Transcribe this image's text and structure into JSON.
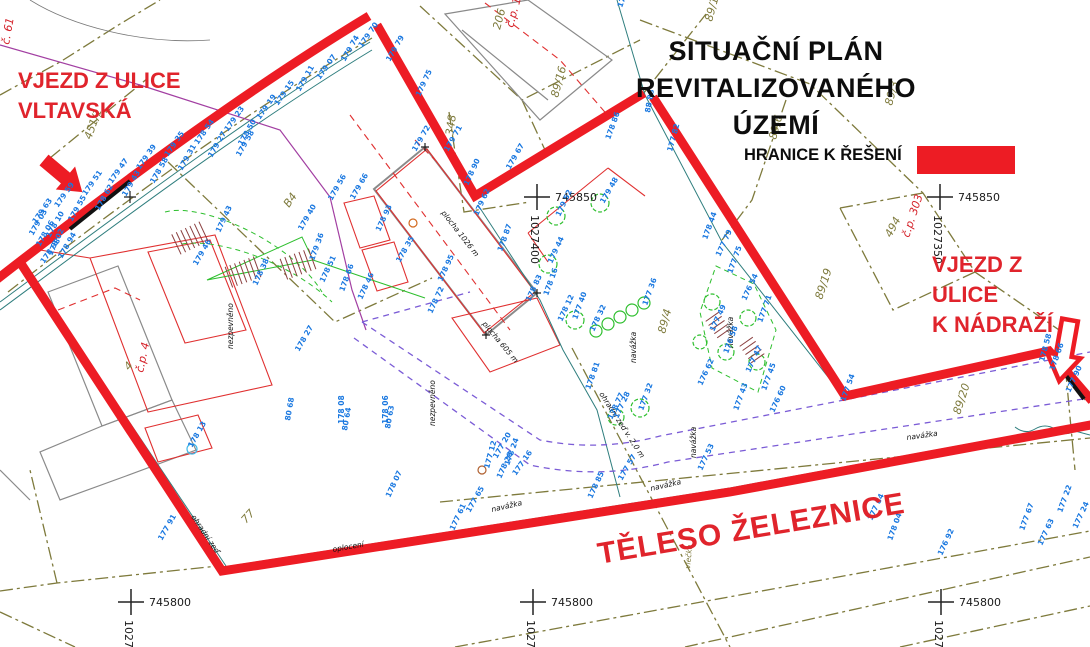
{
  "title": {
    "line1": "SITUAČNÍ PLÁN REVITALIZOVANÉHO",
    "line2": "ÚZEMÍ"
  },
  "legend": {
    "label": "HRANICE K ŘEŠENÍ",
    "swatch_color": "#ED1C24"
  },
  "annotations": {
    "entrance_vltavska": {
      "line1": "VJEZD Z ULICE",
      "line2": "VLTAVSKÁ"
    },
    "entrance_nadrazi": {
      "line1": "VJEZD Z ULICE",
      "line2": "K NÁDRAŽÍ"
    },
    "railway_body": "TĚLESO ŽELEZNICE"
  },
  "colors": {
    "boundary_red": "#ED1C24",
    "annotation_red": "#e0242c",
    "point_blue": "#1a78e0",
    "parcel_olive": "#7e7a3c",
    "teal": "#2f7e7e",
    "violet_dashed": "#7b5cd6",
    "purple": "#a23fa2",
    "green": "#2ebf2e",
    "hatch_brown": "#8b4040"
  },
  "grid_crosses": [
    {
      "x": 537,
      "y": 197,
      "easting": "745850",
      "northing": "1027400"
    },
    {
      "x": 940,
      "y": 197,
      "easting": "745850",
      "northing": "1027350"
    },
    {
      "x": 131,
      "y": 602,
      "easting": "745800",
      "northing": "1027450"
    },
    {
      "x": 533,
      "y": 602,
      "easting": "745800",
      "northing": "1027400"
    },
    {
      "x": 941,
      "y": 602,
      "easting": "745800",
      "northing": "1027350"
    }
  ],
  "parcel_labels": [
    {
      "t": "89/16",
      "x": 558,
      "y": 98,
      "r": -75,
      "c": "olive"
    },
    {
      "t": "89/11",
      "x": 712,
      "y": 22,
      "r": -75,
      "c": "olive"
    },
    {
      "t": "89/3",
      "x": 892,
      "y": 106,
      "r": -75,
      "c": "olive"
    },
    {
      "t": "89/6",
      "x": 776,
      "y": 140,
      "r": -75,
      "c": "olive"
    },
    {
      "t": "89/19",
      "x": 822,
      "y": 300,
      "r": -72,
      "c": "olive"
    },
    {
      "t": "89/20",
      "x": 960,
      "y": 415,
      "r": -72,
      "c": "olive"
    },
    {
      "t": "89/4",
      "x": 665,
      "y": 334,
      "r": -75,
      "c": "olive"
    },
    {
      "t": "348",
      "x": 453,
      "y": 136,
      "r": -82,
      "c": "olive"
    },
    {
      "t": "B4",
      "x": 289,
      "y": 208,
      "r": -55,
      "c": "olive"
    },
    {
      "t": "206",
      "x": 500,
      "y": 30,
      "r": -75,
      "c": "olive"
    },
    {
      "t": "451/1",
      "x": 91,
      "y": 140,
      "r": -70,
      "c": "olive"
    },
    {
      "t": "4",
      "x": 129,
      "y": 371,
      "r": -50,
      "c": "olive"
    },
    {
      "t": "77",
      "x": 246,
      "y": 524,
      "r": -48,
      "c": "olive"
    },
    {
      "t": "494",
      "x": 891,
      "y": 238,
      "r": -62,
      "c": "olive"
    },
    {
      "t": "č.p. 177",
      "x": 513,
      "y": 28,
      "r": -75,
      "c": "red"
    },
    {
      "t": "č.p. 303",
      "x": 909,
      "y": 238,
      "r": -72,
      "c": "red"
    },
    {
      "t": "č.p. 4",
      "x": 143,
      "y": 373,
      "r": -78,
      "c": "red"
    },
    {
      "t": "č. 61",
      "x": 9,
      "y": 45,
      "r": -80,
      "c": "red"
    }
  ],
  "surface_labels": [
    {
      "t": "nezpevněno",
      "x": 233,
      "y": 349,
      "r": -90
    },
    {
      "t": "nezpevněno",
      "x": 435,
      "y": 426,
      "r": -90
    },
    {
      "t": "navážka",
      "x": 636,
      "y": 363,
      "r": -90
    },
    {
      "t": "navážka",
      "x": 733,
      "y": 348,
      "r": -90
    },
    {
      "t": "navážka",
      "x": 696,
      "y": 458,
      "r": -90
    },
    {
      "t": "navážka",
      "x": 492,
      "y": 512,
      "r": -13
    },
    {
      "t": "navážka",
      "x": 651,
      "y": 491,
      "r": -13
    },
    {
      "t": "navážka",
      "x": 907,
      "y": 440,
      "r": -8
    },
    {
      "t": "ohradní zeď",
      "x": 191,
      "y": 517,
      "r": 56
    },
    {
      "t": "ohradní zeď v. 2,0 m",
      "x": 599,
      "y": 394,
      "r": 57
    },
    {
      "t": "oplocení",
      "x": 333,
      "y": 552,
      "r": -10
    },
    {
      "t": "plocha 1026 m",
      "x": 441,
      "y": 213,
      "r": 52
    },
    {
      "t": "plocha 605 m",
      "x": 482,
      "y": 324,
      "r": 50
    },
    {
      "t": "vlečka",
      "x": 690,
      "y": 569,
      "r": -85,
      "c": "olive"
    }
  ],
  "point_labels": [
    {
      "t": "179 63",
      "x": 36,
      "y": 224,
      "r": -55
    },
    {
      "t": "178 10",
      "x": 50,
      "y": 238,
      "r": -60
    },
    {
      "t": "179 59",
      "x": 58,
      "y": 208,
      "r": -55
    },
    {
      "t": "179 55",
      "x": 72,
      "y": 222,
      "r": -60
    },
    {
      "t": "179 51",
      "x": 86,
      "y": 196,
      "r": -55
    },
    {
      "t": "178 62",
      "x": 99,
      "y": 211,
      "r": -60
    },
    {
      "t": "179 47",
      "x": 112,
      "y": 184,
      "r": -55
    },
    {
      "t": "179 43",
      "x": 126,
      "y": 197,
      "r": -60
    },
    {
      "t": "179 39",
      "x": 140,
      "y": 170,
      "r": -55
    },
    {
      "t": "178 58",
      "x": 154,
      "y": 184,
      "r": -60
    },
    {
      "t": "179 35",
      "x": 168,
      "y": 157,
      "r": -55
    },
    {
      "t": "179 31",
      "x": 182,
      "y": 171,
      "r": -60
    },
    {
      "t": "178 54",
      "x": 198,
      "y": 145,
      "r": -55
    },
    {
      "t": "179 27",
      "x": 212,
      "y": 158,
      "r": -60
    },
    {
      "t": "179 23",
      "x": 228,
      "y": 132,
      "r": -55
    },
    {
      "t": "178 50",
      "x": 242,
      "y": 146,
      "r": -60
    },
    {
      "t": "179 19",
      "x": 260,
      "y": 120,
      "r": -55
    },
    {
      "t": "179 15",
      "x": 278,
      "y": 106,
      "r": -55
    },
    {
      "t": "179 11",
      "x": 300,
      "y": 92,
      "r": -60
    },
    {
      "t": "179 07",
      "x": 320,
      "y": 80,
      "r": -55
    },
    {
      "t": "179 74",
      "x": 345,
      "y": 62,
      "r": -60
    },
    {
      "t": "179 70",
      "x": 362,
      "y": 48,
      "r": -55
    },
    {
      "t": "178 06",
      "x": 40,
      "y": 247,
      "r": -60
    },
    {
      "t": "178 02",
      "x": 52,
      "y": 256,
      "r": -65
    },
    {
      "t": "178 98",
      "x": 44,
      "y": 264,
      "r": -55
    },
    {
      "t": "178 94",
      "x": 62,
      "y": 259,
      "r": -60
    },
    {
      "t": "179 03",
      "x": 33,
      "y": 236,
      "r": -60
    },
    {
      "t": "179 79",
      "x": 390,
      "y": 62,
      "r": -60
    },
    {
      "t": "179 75",
      "x": 420,
      "y": 97,
      "r": -65
    },
    {
      "t": "179 71",
      "x": 448,
      "y": 152,
      "r": -60
    },
    {
      "t": "178 90",
      "x": 468,
      "y": 186,
      "r": -65
    },
    {
      "t": "88 88",
      "x": 650,
      "y": 113,
      "r": -80
    },
    {
      "t": "178 86",
      "x": 610,
      "y": 140,
      "r": -70
    },
    {
      "t": "177 82",
      "x": 672,
      "y": 152,
      "r": -75
    },
    {
      "t": "179 67",
      "x": 510,
      "y": 170,
      "r": -60
    },
    {
      "t": "179 62",
      "x": 478,
      "y": 216,
      "r": -65
    },
    {
      "t": "178 87",
      "x": 502,
      "y": 252,
      "r": -70
    },
    {
      "t": "178 83",
      "x": 530,
      "y": 302,
      "r": -65
    },
    {
      "t": "179 66",
      "x": 354,
      "y": 200,
      "r": -60
    },
    {
      "t": "178 93",
      "x": 380,
      "y": 232,
      "r": -65
    },
    {
      "t": "179 72",
      "x": 416,
      "y": 152,
      "r": -60
    },
    {
      "t": "178 95",
      "x": 442,
      "y": 282,
      "r": -65
    },
    {
      "t": "178 16",
      "x": 548,
      "y": 296,
      "r": -70
    },
    {
      "t": "178 12",
      "x": 562,
      "y": 322,
      "r": -65
    },
    {
      "t": "178 81",
      "x": 590,
      "y": 390,
      "r": -70
    },
    {
      "t": "178 77",
      "x": 612,
      "y": 420,
      "r": -65
    },
    {
      "t": "179 58",
      "x": 240,
      "y": 157,
      "r": -60
    },
    {
      "t": "179 43",
      "x": 220,
      "y": 233,
      "r": -65
    },
    {
      "t": "179 40",
      "x": 302,
      "y": 231,
      "r": -60
    },
    {
      "t": "179 36",
      "x": 314,
      "y": 261,
      "r": -70
    },
    {
      "t": "178 51",
      "x": 324,
      "y": 283,
      "r": -65
    },
    {
      "t": "179 46",
      "x": 197,
      "y": 266,
      "r": -60
    },
    {
      "t": "178 38",
      "x": 257,
      "y": 286,
      "r": -65
    },
    {
      "t": "179 56",
      "x": 332,
      "y": 201,
      "r": -60
    },
    {
      "t": "178 35",
      "x": 400,
      "y": 263,
      "r": -60
    },
    {
      "t": "178 46",
      "x": 362,
      "y": 300,
      "r": -65
    },
    {
      "t": "178 27",
      "x": 299,
      "y": 352,
      "r": -60
    },
    {
      "t": "178 08",
      "x": 344,
      "y": 424,
      "r": -90
    },
    {
      "t": "178 06",
      "x": 388,
      "y": 424,
      "r": -90
    },
    {
      "t": "178 07",
      "x": 390,
      "y": 498,
      "r": -65
    },
    {
      "t": "178 66",
      "x": 344,
      "y": 292,
      "r": -70
    },
    {
      "t": "178 72",
      "x": 432,
      "y": 314,
      "r": -65
    },
    {
      "t": "80 64",
      "x": 347,
      "y": 431,
      "r": -80
    },
    {
      "t": "80 63",
      "x": 390,
      "y": 429,
      "r": -80
    },
    {
      "t": "80 68",
      "x": 290,
      "y": 421,
      "r": -80
    },
    {
      "t": "177 20",
      "x": 497,
      "y": 459,
      "r": -60
    },
    {
      "t": "178 24",
      "x": 509,
      "y": 466,
      "r": -70
    },
    {
      "t": "177 16",
      "x": 516,
      "y": 476,
      "r": -55
    },
    {
      "t": "178 28",
      "x": 501,
      "y": 479,
      "r": -65
    },
    {
      "t": "177 12",
      "x": 489,
      "y": 469,
      "r": -75
    },
    {
      "t": "177 40",
      "x": 577,
      "y": 320,
      "r": -70
    },
    {
      "t": "178 32",
      "x": 594,
      "y": 332,
      "r": -65
    },
    {
      "t": "177 36",
      "x": 647,
      "y": 306,
      "r": -70
    },
    {
      "t": "179 52",
      "x": 560,
      "y": 217,
      "r": -65
    },
    {
      "t": "179 48",
      "x": 604,
      "y": 204,
      "r": -60
    },
    {
      "t": "179 44",
      "x": 552,
      "y": 264,
      "r": -65
    },
    {
      "t": "177 32",
      "x": 643,
      "y": 411,
      "r": -70
    },
    {
      "t": "177 28",
      "x": 618,
      "y": 419,
      "r": -65
    },
    {
      "t": "178 44",
      "x": 707,
      "y": 240,
      "r": -70
    },
    {
      "t": "177 79",
      "x": 720,
      "y": 257,
      "r": -65
    },
    {
      "t": "177 75",
      "x": 732,
      "y": 274,
      "r": -70
    },
    {
      "t": "176 54",
      "x": 746,
      "y": 301,
      "r": -65
    },
    {
      "t": "177 71",
      "x": 762,
      "y": 323,
      "r": -70
    },
    {
      "t": "177 49",
      "x": 714,
      "y": 332,
      "r": -65
    },
    {
      "t": "176 58",
      "x": 728,
      "y": 354,
      "r": -70
    },
    {
      "t": "177 47",
      "x": 750,
      "y": 373,
      "r": -65
    },
    {
      "t": "177 45",
      "x": 766,
      "y": 391,
      "r": -70
    },
    {
      "t": "176 62",
      "x": 702,
      "y": 386,
      "r": -65
    },
    {
      "t": "177 43",
      "x": 738,
      "y": 411,
      "r": -70
    },
    {
      "t": "176 60",
      "x": 774,
      "y": 413,
      "r": -65
    },
    {
      "t": "177 54",
      "x": 845,
      "y": 402,
      "r": -70
    },
    {
      "t": "177 84",
      "x": 872,
      "y": 521,
      "r": -65
    },
    {
      "t": "178 04",
      "x": 892,
      "y": 541,
      "r": -70
    },
    {
      "t": "176 92",
      "x": 942,
      "y": 556,
      "r": -65
    },
    {
      "t": "177 67",
      "x": 1024,
      "y": 531,
      "r": -70
    },
    {
      "t": "177 63",
      "x": 1042,
      "y": 546,
      "r": -65
    },
    {
      "t": "177 22",
      "x": 1062,
      "y": 513,
      "r": -70
    },
    {
      "t": "177 24",
      "x": 1077,
      "y": 529,
      "r": -65
    },
    {
      "t": "178 66",
      "x": 1054,
      "y": 371,
      "r": -70
    },
    {
      "t": "177 90",
      "x": 1070,
      "y": 393,
      "r": -65
    },
    {
      "t": "178 58",
      "x": 1044,
      "y": 362,
      "r": -75
    },
    {
      "t": "177 91",
      "x": 162,
      "y": 541,
      "r": -60
    },
    {
      "t": "177 61",
      "x": 454,
      "y": 531,
      "r": -65
    },
    {
      "t": "177 65",
      "x": 470,
      "y": 513,
      "r": -60
    },
    {
      "t": "178 85",
      "x": 592,
      "y": 499,
      "r": -65
    },
    {
      "t": "177 57",
      "x": 622,
      "y": 481,
      "r": -60
    },
    {
      "t": "177 53",
      "x": 702,
      "y": 471,
      "r": -65
    },
    {
      "t": "178 13",
      "x": 192,
      "y": 448,
      "r": -60
    },
    {
      "t": "179 83",
      "x": 622,
      "y": 8,
      "r": -70
    }
  ]
}
